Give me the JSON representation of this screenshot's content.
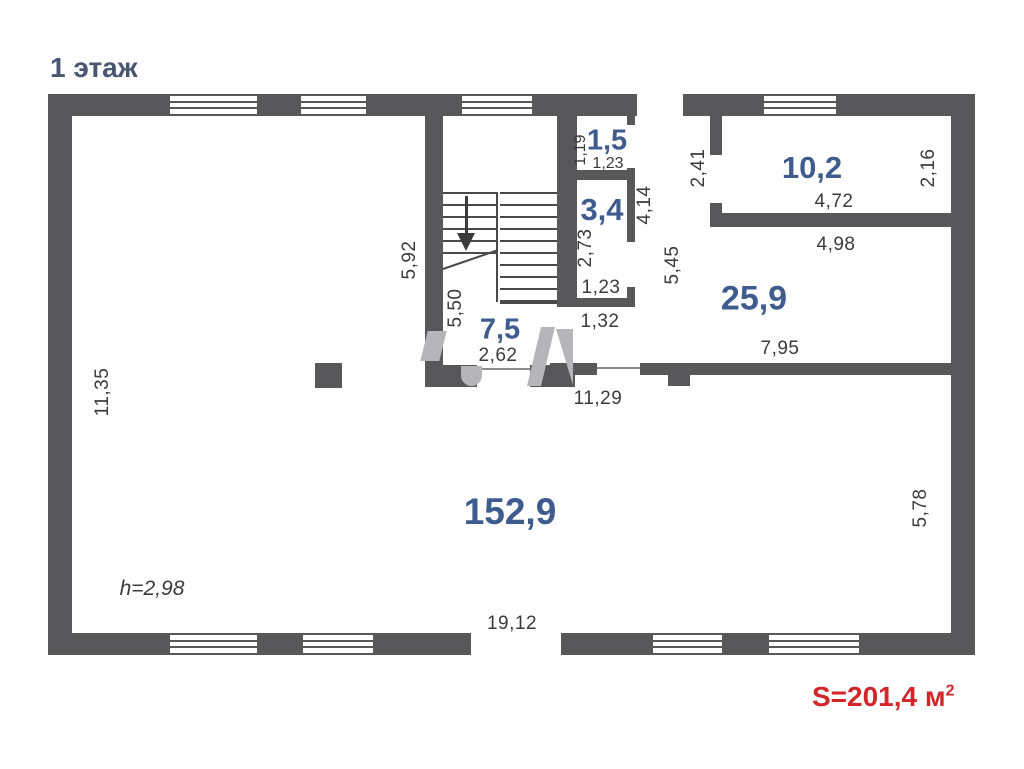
{
  "title": "1 этаж",
  "floor_plan": {
    "rooms": {
      "main_hall": "152,9",
      "room_25_9": "25,9",
      "room_10_2": "10,2",
      "stair_hall": "7,5",
      "room_3_4": "3,4",
      "room_1_5": "1,5"
    },
    "ceiling_height": "h=2,98",
    "dimensions": {
      "left_height": "11,35",
      "stairwell_height": "5,92",
      "stair_hall_height": "5,50",
      "stair_hall_width": "2,62",
      "room_1_5_height": "1,19",
      "room_1_5_width": "1,23",
      "room_3_4_height": "2,73",
      "room_3_4_width": "1,23",
      "passage_width": "1,32",
      "corridor_top": "4,14",
      "corridor_height": "5,45",
      "door_2_41": "2,41",
      "room_10_2_width": "4,72",
      "room_10_2_height": "2,16",
      "room_25_9_top": "4,98",
      "room_25_9_bottom": "7,95",
      "hall_top_width": "11,29",
      "right_height": "5,78",
      "hall_bottom_width": "19,12"
    }
  },
  "total_area": {
    "label": "S=201,4 м",
    "superscript": "2"
  }
}
